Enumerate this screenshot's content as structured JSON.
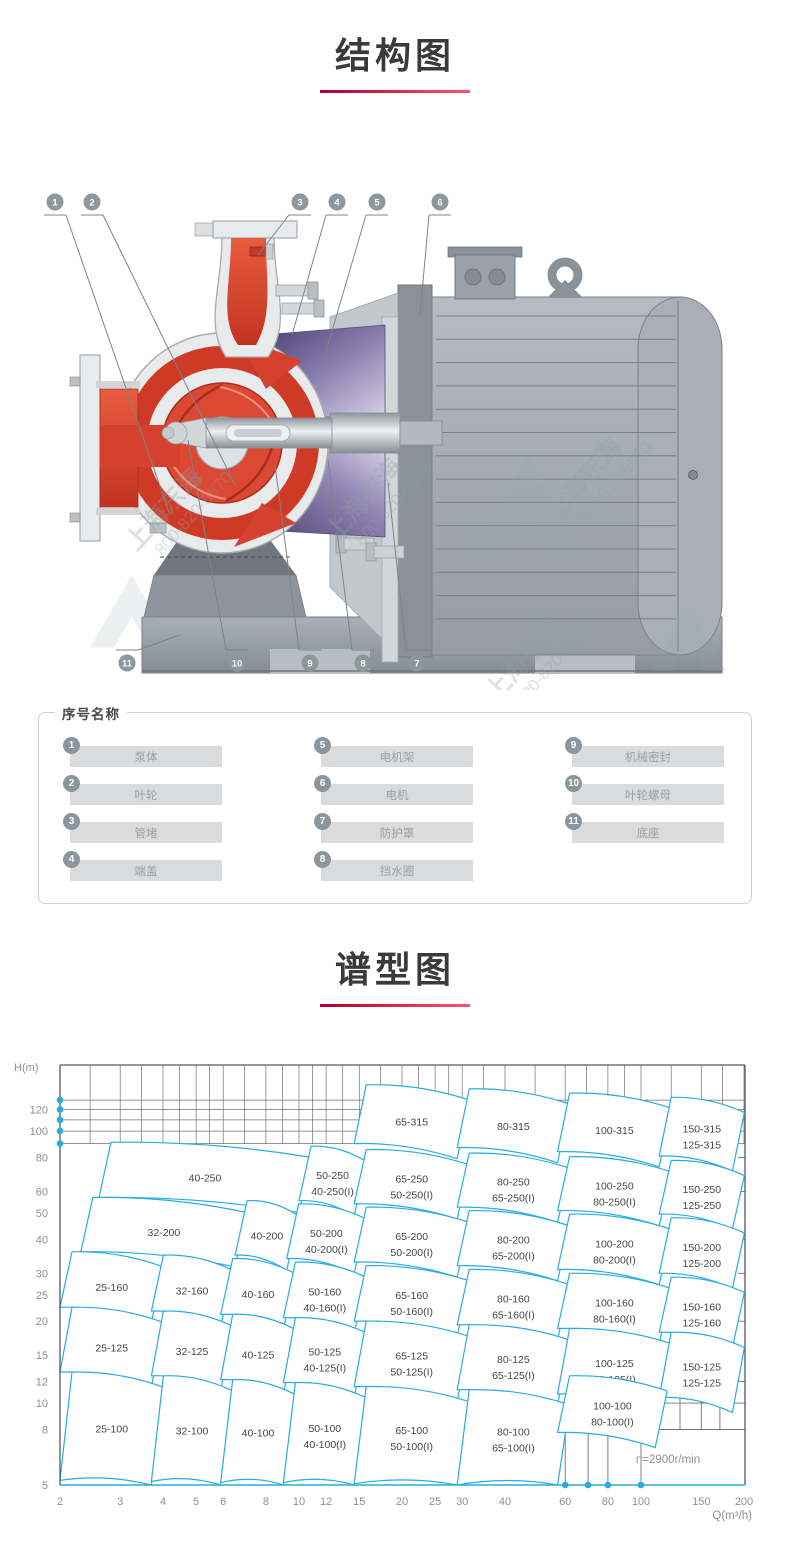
{
  "page": {
    "background": "#ffffff"
  },
  "colors": {
    "accent_red_dark": "#ad0030",
    "accent_red_light": "#fa5670",
    "chart_blue": "#29abe2",
    "title_text": "#3a3a3c",
    "pump_red": "#d6402e",
    "bracket_purple": "#6b5b92",
    "metal_gray": "#a2a9af"
  },
  "sections": {
    "structure": {
      "title": "结构图"
    },
    "spectrum": {
      "title": "谱型图"
    }
  },
  "diagram": {
    "watermark": {
      "line1": "上海东海",
      "line2": "800-820-6570"
    },
    "callouts": {
      "top": [
        "1",
        "2",
        "3",
        "4",
        "5",
        "6"
      ],
      "bottom": [
        "11",
        "10",
        "9",
        "8",
        "7"
      ]
    }
  },
  "parts_panel": {
    "title": "序号名称",
    "columns": [
      [
        {
          "no": "1",
          "name": "泵体"
        },
        {
          "no": "2",
          "name": "叶轮"
        },
        {
          "no": "3",
          "name": "管堵"
        },
        {
          "no": "4",
          "name": "端盖"
        }
      ],
      [
        {
          "no": "5",
          "name": "电机架"
        },
        {
          "no": "6",
          "name": "电机"
        },
        {
          "no": "7",
          "name": "防护罩"
        },
        {
          "no": "8",
          "name": "挡水圈"
        }
      ],
      [
        {
          "no": "9",
          "name": "机械密封"
        },
        {
          "no": "10",
          "name": "叶轮螺母"
        },
        {
          "no": "11",
          "name": "底座"
        }
      ]
    ]
  },
  "chart_data": {
    "type": "region-map",
    "title": "谱型图",
    "xlabel": "Q(m³/h)",
    "ylabel": "H(m)",
    "x_scale": "log",
    "y_scale": "log",
    "xlim": [
      2,
      200
    ],
    "ylim": [
      5,
      175
    ],
    "x_ticks": [
      2,
      3,
      4,
      5,
      6,
      8,
      10,
      12,
      15,
      20,
      25,
      30,
      40,
      60,
      80,
      100,
      150,
      200
    ],
    "y_ticks": [
      120,
      100,
      80,
      60,
      50,
      40,
      30,
      25,
      20,
      15,
      12,
      10,
      8,
      5
    ],
    "grid_h_values": [
      90,
      100,
      110,
      120,
      130
    ],
    "axis_dots_y": [
      90,
      100,
      110,
      120,
      130
    ],
    "axis_dots_x": [
      60,
      70,
      80,
      100
    ],
    "right_edge_ticks_h": [
      20,
      25,
      30,
      40,
      60,
      80
    ],
    "sub_grid": {
      "verticals_q": [
        60,
        70,
        80,
        100
      ],
      "verticals_h_span": [
        5,
        8
      ],
      "horizontals_h": [
        8,
        10,
        12
      ],
      "horizontals_q_span": [
        110,
        200
      ],
      "cell_verticals_q": [
        130,
        150,
        170
      ],
      "cell_verticals_h_span": [
        8,
        12
      ]
    },
    "annotation": "n=2900r/min",
    "legend_position": "none",
    "grid": true,
    "regions": [
      {
        "labels": [
          "65-315"
        ],
        "q": [
          14.5,
          29
        ],
        "h": [
          90,
          148
        ]
      },
      {
        "labels": [
          "80-315"
        ],
        "q": [
          29,
          57
        ],
        "h": [
          87,
          143
        ]
      },
      {
        "labels": [
          "100-315"
        ],
        "q": [
          57,
          113
        ],
        "h": [
          84,
          138
        ]
      },
      {
        "labels": [
          "150-315",
          "125-315"
        ],
        "q": [
          113,
          185
        ],
        "h": [
          81,
          133
        ]
      },
      {
        "labels": [
          "40-250"
        ],
        "q": [
          2.6,
          10
        ],
        "h": [
          57,
          91
        ]
      },
      {
        "labels": [
          "50-250",
          "40-250(I)"
        ],
        "q": [
          10,
          14.5
        ],
        "h": [
          55.5,
          88
        ]
      },
      {
        "labels": [
          "65-250",
          "50-250(I)"
        ],
        "q": [
          14.5,
          29
        ],
        "h": [
          54,
          85.5
        ]
      },
      {
        "labels": [
          "80-250",
          "65-250(I)"
        ],
        "q": [
          29,
          57
        ],
        "h": [
          52.5,
          83
        ]
      },
      {
        "labels": [
          "100-250",
          "80-250(I)"
        ],
        "q": [
          57,
          113
        ],
        "h": [
          51,
          80.5
        ]
      },
      {
        "labels": [
          "150-250",
          "125-250"
        ],
        "q": [
          113,
          185
        ],
        "h": [
          49.5,
          78
        ]
      },
      {
        "labels": [
          "32-200"
        ],
        "q": [
          2.3,
          6.5
        ],
        "h": [
          36,
          57
        ]
      },
      {
        "labels": [
          "40-200"
        ],
        "q": [
          6.5,
          9.2
        ],
        "h": [
          35,
          55.5
        ]
      },
      {
        "labels": [
          "50-200",
          "40-200(I)"
        ],
        "q": [
          9.2,
          14.5
        ],
        "h": [
          34,
          54
        ]
      },
      {
        "labels": [
          "65-200",
          "50-200(I)"
        ],
        "q": [
          14.5,
          29
        ],
        "h": [
          33,
          52.5
        ]
      },
      {
        "labels": [
          "80-200",
          "65-200(I)"
        ],
        "q": [
          29,
          57
        ],
        "h": [
          32,
          51
        ]
      },
      {
        "labels": [
          "100-200",
          "80-200(I)"
        ],
        "q": [
          57,
          113
        ],
        "h": [
          31,
          49.5
        ]
      },
      {
        "labels": [
          "150-200",
          "125-200"
        ],
        "q": [
          113,
          185
        ],
        "h": [
          30,
          48
        ]
      },
      {
        "labels": [
          "25-160"
        ],
        "q": [
          2,
          3.7
        ],
        "h": [
          22.5,
          36
        ]
      },
      {
        "labels": [
          "32-160"
        ],
        "q": [
          3.7,
          5.9
        ],
        "h": [
          21.8,
          35
        ]
      },
      {
        "labels": [
          "40-160"
        ],
        "q": [
          5.9,
          9
        ],
        "h": [
          21.2,
          34
        ]
      },
      {
        "labels": [
          "50-160",
          "40-160(I)"
        ],
        "q": [
          9,
          14.5
        ],
        "h": [
          20.6,
          33
        ]
      },
      {
        "labels": [
          "65-160",
          "50-160(I)"
        ],
        "q": [
          14.5,
          29
        ],
        "h": [
          20,
          32
        ]
      },
      {
        "labels": [
          "80-160",
          "65-160(I)"
        ],
        "q": [
          29,
          57
        ],
        "h": [
          19.4,
          31
        ]
      },
      {
        "labels": [
          "100-160",
          "80-160(I)"
        ],
        "q": [
          57,
          113
        ],
        "h": [
          18.8,
          30
        ]
      },
      {
        "labels": [
          "150-160",
          "125-160"
        ],
        "q": [
          113,
          185
        ],
        "h": [
          18.2,
          29
        ]
      },
      {
        "labels": [
          "25-125"
        ],
        "q": [
          2,
          3.7
        ],
        "h": [
          13,
          22.5
        ]
      },
      {
        "labels": [
          "32-125"
        ],
        "q": [
          3.7,
          5.9
        ],
        "h": [
          12.6,
          21.8
        ]
      },
      {
        "labels": [
          "40-125"
        ],
        "q": [
          5.9,
          9
        ],
        "h": [
          12.2,
          21.2
        ]
      },
      {
        "labels": [
          "50-125",
          "40-125(I)"
        ],
        "q": [
          9,
          14.5
        ],
        "h": [
          11.9,
          20.6
        ]
      },
      {
        "labels": [
          "65-125",
          "50-125(I)"
        ],
        "q": [
          14.5,
          29
        ],
        "h": [
          11.5,
          20
        ]
      },
      {
        "labels": [
          "80-125",
          "65-125(I)"
        ],
        "q": [
          29,
          57
        ],
        "h": [
          11.2,
          19.4
        ]
      },
      {
        "labels": [
          "100-125",
          "80-125(I)"
        ],
        "q": [
          57,
          113
        ],
        "h": [
          10.8,
          18.8
        ]
      },
      {
        "labels": [
          "150-125",
          "125-125"
        ],
        "q": [
          113,
          185
        ],
        "h": [
          10.5,
          18.2
        ]
      },
      {
        "labels": [
          "25-100"
        ],
        "q": [
          2,
          3.7
        ],
        "h": [
          5.2,
          13
        ]
      },
      {
        "labels": [
          "32-100"
        ],
        "q": [
          3.7,
          5.9
        ],
        "h": [
          5.15,
          12.6
        ]
      },
      {
        "labels": [
          "40-100"
        ],
        "q": [
          5.9,
          9
        ],
        "h": [
          5.1,
          12.2
        ]
      },
      {
        "labels": [
          "50-100",
          "40-100(I)"
        ],
        "q": [
          9,
          14.5
        ],
        "h": [
          5.1,
          11.9
        ]
      },
      {
        "labels": [
          "65-100",
          "50-100(I)"
        ],
        "q": [
          14.5,
          29
        ],
        "h": [
          5.05,
          11.5
        ]
      },
      {
        "labels": [
          "80-100",
          "65-100(I)"
        ],
        "q": [
          29,
          57
        ],
        "h": [
          5,
          11.2
        ]
      },
      {
        "labels": [
          "100-100",
          "80-100(I)"
        ],
        "q": [
          57,
          110
        ],
        "h": [
          7.8,
          12.6
        ]
      }
    ]
  }
}
